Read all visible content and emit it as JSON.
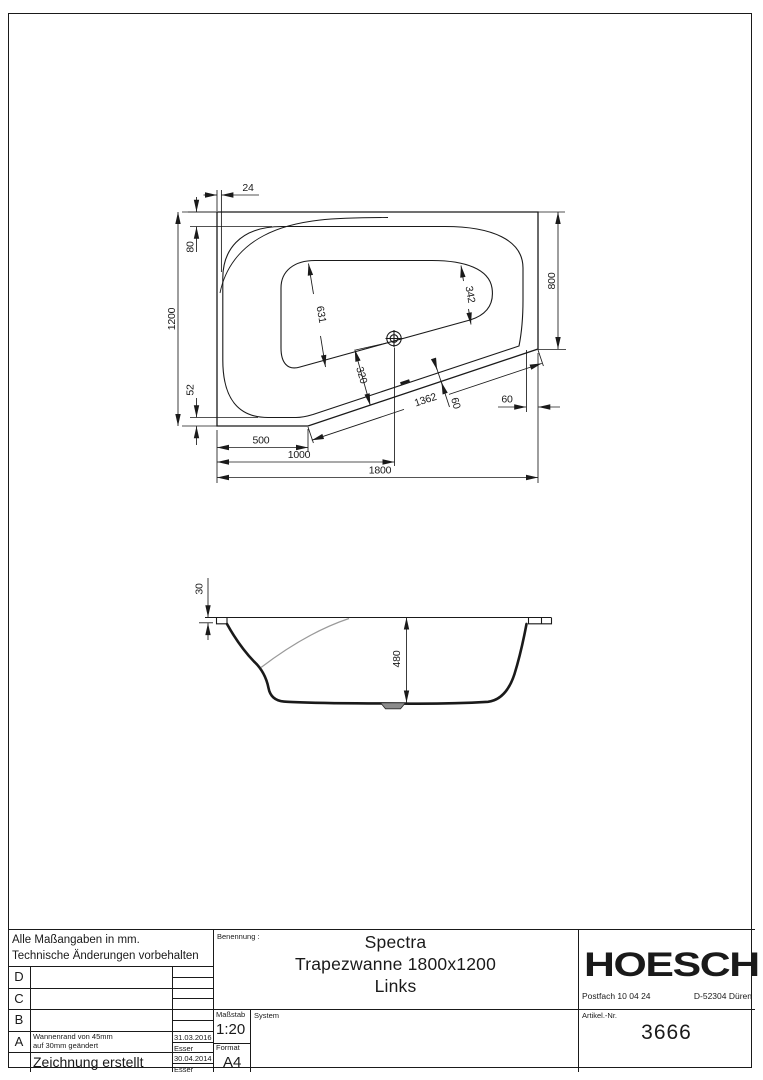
{
  "drawing": {
    "plan": {
      "d24": "24",
      "d80": "80",
      "d1200": "1200",
      "d52": "52",
      "d800": "800",
      "d631": "631",
      "d342": "342",
      "d320": "320",
      "d1362": "1362",
      "d60_slant": "60",
      "d60_right": "60",
      "d500": "500",
      "d1000": "1000",
      "d1800": "1800"
    },
    "section": {
      "d30": "30",
      "d480": "480"
    }
  },
  "title_block": {
    "note_line1": "Alle Maßangaben in mm.",
    "note_line2": "Technische Änderungen vorbehalten",
    "revisions": [
      {
        "letter": "D",
        "desc": "",
        "date": "",
        "name": ""
      },
      {
        "letter": "C",
        "desc": "",
        "date": "",
        "name": ""
      },
      {
        "letter": "B",
        "desc": "",
        "date": "",
        "name": ""
      },
      {
        "letter": "A",
        "desc_line1": "Wannenrand von 45mm",
        "desc_line2": "auf 30mm geändert",
        "date": "31.03.2016",
        "name": "Esser"
      },
      {
        "letter": "",
        "desc": "Zeichnung erstellt",
        "date": "30.04.2014",
        "name": "Esser"
      }
    ],
    "benennung_label": "Benennung :",
    "title_line1": "Spectra",
    "title_line2": "Trapezwanne 1800x1200",
    "title_line3": "Links",
    "massstab_label": "Maßstab",
    "massstab_value": "1:20",
    "format_label": "Format",
    "format_value": "A4",
    "system_label": "System",
    "logo": "HOESCH",
    "address_left": "Postfach 10 04 24",
    "address_right": "D-52304 Düren",
    "artikel_label": "Artikel.-Nr.",
    "artikel_value": "3666"
  },
  "colors": {
    "line": "#1a1a1a",
    "gray_line": "#9a9a9a",
    "drain_fill": "#8c8c8c"
  }
}
